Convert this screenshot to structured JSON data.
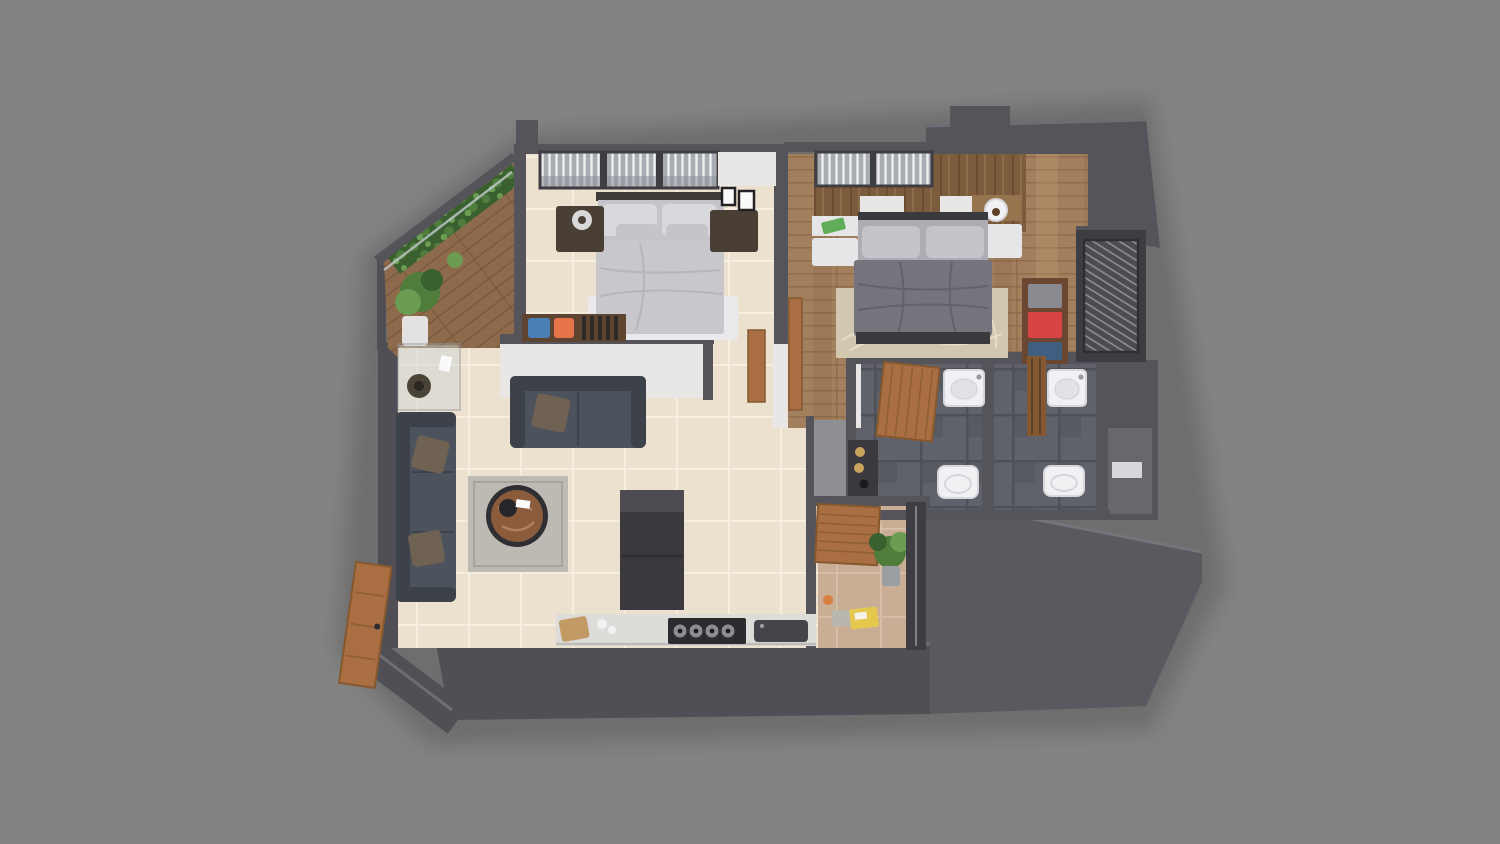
{
  "scene": {
    "type": "3d-isometric-floorplan-render",
    "background_color": "#828282",
    "rooms": [
      {
        "id": "bedroom-1",
        "floor": "beige-ceramic-tile",
        "objects": [
          "double-bed",
          "nightstand-arc-lamp",
          "nightstand-picture-frames",
          "wall-shelf-folded-clothes",
          "louver-window-wall"
        ]
      },
      {
        "id": "master-bedroom",
        "floor": "wood-plank",
        "objects": [
          "double-bed-dark-duvet",
          "wood-headboard-wall",
          "white-nightstand-green-book",
          "white-nightstand-drum-lamp",
          "open-wardrobe-clothes",
          "patterned-rug",
          "louver-window",
          "private-balcony-railing"
        ]
      },
      {
        "id": "bathroom-1",
        "floor": "dark-slate-tile",
        "objects": [
          "wall-hung-washbasin",
          "toilet",
          "wood-door"
        ]
      },
      {
        "id": "bathroom-2",
        "floor": "dark-slate-tile",
        "objects": [
          "wall-hung-washbasin",
          "toilet",
          "wood-door"
        ]
      },
      {
        "id": "hallway",
        "objects": [
          "wood-floor-corridor",
          "console-with-candles",
          "wood-doors"
        ]
      },
      {
        "id": "living-room",
        "floor": "beige-ceramic-tile",
        "objects": [
          "three-seat-sofa",
          "two-seat-sofa",
          "throw-pillows",
          "round-marble-coffee-table",
          "area-rug",
          "glass-console-table",
          "table-lamp"
        ]
      },
      {
        "id": "kitchen",
        "objects": [
          "refrigerator",
          "counter-gas-hob",
          "sink",
          "cutting-board"
        ]
      },
      {
        "id": "garden-balcony",
        "floor": "wood-deck",
        "objects": [
          "vertical-garden-wall",
          "potted-plant",
          "small-plant",
          "glass-balustrade"
        ]
      },
      {
        "id": "utility-balcony",
        "floor": "terracotta-tile",
        "objects": [
          "louvered-wood-door",
          "potted-plant",
          "storage-boxes",
          "glass-railing"
        ]
      },
      {
        "id": "entrance",
        "objects": [
          "wood-entry-door",
          "chamfered-corner-wall"
        ]
      }
    ]
  },
  "palette": {
    "bg": "#828282",
    "shadow": "#000000",
    "wallTop": "#55545a",
    "wallTopLight": "#6e6d73",
    "wallEdgeHighlight": "#75747a",
    "wallBandBottom": "#504f55",
    "wallSlab": "#5a595f",
    "wallLeftBand": "#4f4e54",
    "wallFace": "#e9e7e5",
    "niche": "#68676d",
    "lobbyFloor": "#8f8e93",
    "tileFloor": "#ece1cf",
    "tileLine": "#f7efe1",
    "glassBand": "#a9adb3",
    "glassShade": "#8e949a",
    "blindLine": "#eceded",
    "railDark": "#3e3d43",
    "railBar": "#90929a",
    "railFrame": "#2f2e33",
    "balustrade": "#c3c9cc",
    "woodFloor": "#a3805d",
    "woodDark": "#7f5c3f",
    "woodLight": "#b8946d",
    "headboardWood": "#7d5c3e",
    "headboardLight": "#96744e",
    "headboardDark": "#5e4227",
    "deckWood": "#8d6a4b",
    "deckDark": "#6f4f36",
    "darkTileFloor": "#5f626a",
    "darkTileLine": "#4e5158",
    "floorUtility": "#c9ad94",
    "utilityTileLine": "#d8bfa8",
    "plantGreen": "#4e7d3c",
    "plantGreenDark": "#39602e",
    "plantGreenLight": "#6a9c51",
    "potWhite": "#e3e2e0",
    "potGray": "#9aa0a2",
    "sofa": "#4d535c",
    "sofaShade": "#3d424a",
    "cushion": "#6f6253",
    "rugLiving": "#bdbab4",
    "rugLivingShade": "#a7a49e",
    "rugMaster": "#d2c8b0",
    "rugLine": "#e6dec8",
    "tableRim": "#2f2e33",
    "tableWoodTop": "#8a5c3c",
    "tableMarbleLight": "#b98a63",
    "trayDark": "#26252a",
    "glassTable": "#ced4d6",
    "glassTableEdge": "#8f979b",
    "lampDark": "#4a4438",
    "lampInner": "#2b2823",
    "pillowLight": "#d9d9dd",
    "pillowMid": "#c4c4ca",
    "bedLight": "#c7c7cc",
    "bedLightShade": "#aeaeb6",
    "sheetWhite": "#eaeaed",
    "headboard1": "#3f3a35",
    "nightstandDark": "#4a3f35",
    "nightstandWhite": "#e6e6e8",
    "lampSilver": "#d9d9db",
    "pillowGray": "#aeadb4",
    "bedDark": "#75737c",
    "bedDarkShade": "#5f5c66",
    "benchDark": "#3a3a3e",
    "bookGreen": "#5fae57",
    "closetWood": "#5e4531",
    "clothBlue": "#4a7fb5",
    "clothOrange": "#e8744b",
    "clothRed": "#d84343",
    "clothNavy": "#3f5e80",
    "clothGray": "#8b8a91",
    "clothDarkRow": "#2e2a28",
    "wardrobeWood": "#6b4631",
    "fixtureWhite": "#f1f1f3",
    "fixtureShade": "#d6d6db",
    "basinInner": "#e2e2e6",
    "faucetMetal": "#9a9aa0",
    "applianceDark": "#3a393e",
    "applianceTop": "#4c4b52",
    "applianceSeam": "#2c2b2f",
    "counterTop": "#dddcd8",
    "counterEdge": "#bdbcb8",
    "cooktop": "#2c2b30",
    "burner": "#8d8d93",
    "burnerInner": "#1d1d21",
    "sinkDark": "#45444a",
    "doorWood": "#a96f42",
    "doorWoodDark": "#85582f",
    "candle": "#c9a45c",
    "bottleDark": "#1a191d",
    "yellowBox": "#e7c84e",
    "labelWhite": "#f4f2ea",
    "folderGray": "#b9b6ae",
    "jarOrange": "#d87f3f",
    "frameDark": "#222226",
    "frameWhite": "#fafafa",
    "boardWood": "#c29a66",
    "white": "#ffffff"
  }
}
